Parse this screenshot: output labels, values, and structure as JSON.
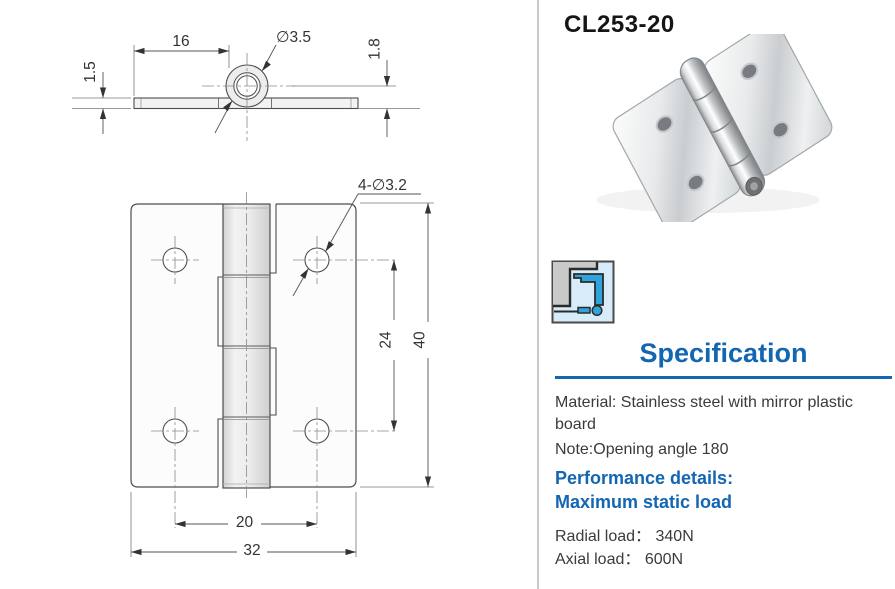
{
  "colors": {
    "accent": "#1266b2",
    "divider": "#c9c9c9",
    "body-text": "#3a3a3a",
    "drawing_line": "#4d4d4d",
    "icon_blue": "#2ea3dc",
    "icon_light_blue_bg": "#d7ecf8",
    "icon_gray": "#c9c9c9",
    "metal_gray": "#c9cdd0"
  },
  "product_code": "CL253-20",
  "drawing": {
    "side_view": {
      "dim_leaf_length": "16",
      "dim_pin_diameter": "∅3.5",
      "dim_thickness": "1.5",
      "dim_knuckle_offset": "1.8"
    },
    "front_view": {
      "dim_holes": "4-∅3.2",
      "dim_hole_spacing_v": "24",
      "dim_height": "40",
      "dim_hole_spacing_h": "20",
      "dim_width": "32"
    }
  },
  "spec": {
    "title": "Specification",
    "material_line1": "Material: Stainless steel with mirror plastic",
    "material_line2": "board",
    "note": "Note:Opening angle 180",
    "performance_heading": "Performance details:",
    "max_load_heading": "Maximum static load",
    "radial_load": "Radial load：  340N",
    "axial_load": "Axial load：  600N"
  }
}
